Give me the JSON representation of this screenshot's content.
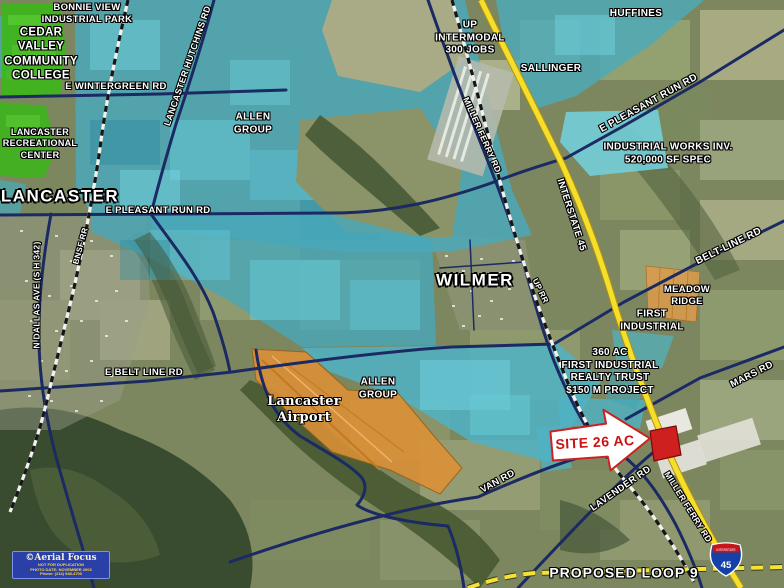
{
  "colors": {
    "overlay_teal": "#49a9bc",
    "overlay_teal_bright": "#72d3e0",
    "overlay_green": "#3db51c",
    "overlay_orange": "#de9136",
    "parcel_red": "#cf2020",
    "road_navy": "#1b2a63",
    "interstate_yellow": "#f4e02c",
    "label_white": "#ffffff",
    "site_label_red": "#cc1111",
    "watermark_blue": "#2a3fa8"
  },
  "cities": {
    "lancaster": "LANCASTER",
    "wilmer": "WILMER"
  },
  "roads": {
    "e_wintergreen": "E WINTERGREEN RD",
    "lancaster_hutchins": "LANCASTER HUTCHINS RD",
    "e_pleasant_run_left": "E PLEASANT RUN RD",
    "e_pleasant_run_right": "E PLEASANT RUN RD",
    "n_dallas_ave": "N DALLAS AVE (S H 342)",
    "miller_ferry_north": "MILLER FERRY RD",
    "miller_ferry_south": "MILLER FERRY RD",
    "interstate_45": "INTERSTATE 45",
    "belt_line_right": "BELT-LINE RD",
    "e_belt_line": "E BELT LINE RD",
    "mars_rd": "MARS RD",
    "van_rd": "VAN RD",
    "lavender_rd": "LAVENDER RD",
    "proposed_loop_9": "PROPOSED LOOP 9"
  },
  "railroads": {
    "bnsf": "BNSF RR",
    "up": "UP RR"
  },
  "landmarks": {
    "bonnie_view": [
      "BONNIE VIEW",
      "INDUSTRIAL PARK"
    ],
    "cedar_valley": [
      "CEDAR",
      "VALLEY",
      "COMMUNITY",
      "COLLEGE"
    ],
    "lancaster_rec": [
      "LANCASTER",
      "RECREATIONAL",
      "CENTER"
    ],
    "allen_group_north": [
      "ALLEN",
      "GROUP"
    ],
    "allen_group_south": [
      "ALLEN",
      "GROUP"
    ],
    "up_intermodal": [
      "UP",
      "INTERMODAL",
      "300 JOBS"
    ],
    "huffines": "HUFFINES",
    "sallinger": "SALLINGER",
    "industrial_works": [
      "INDUSTRIAL WORKS INV.",
      "520,000 SF SPEC"
    ],
    "meadow_ridge": [
      "MEADOW",
      "RIDGE"
    ],
    "first_industrial": [
      "FIRST",
      "INDUSTRIAL"
    ],
    "first_industrial_project": [
      "360 AC",
      "FIRST INDUSTRIAL",
      "REALTY TRUST",
      "$150 M PROJECT"
    ],
    "lancaster_airport": [
      "Lancaster",
      "Airport"
    ]
  },
  "site_callout": {
    "label": "SITE 26 AC"
  },
  "interstate_shield": {
    "top": "INTERSTATE",
    "number": "45"
  },
  "watermark": {
    "title": "©Aerial Focus",
    "line1": "NOT FOR DUPLICATION",
    "line2": "PHOTO DATE: NOVEMBER 2003",
    "line3": "Phone: (214) 948-4700"
  }
}
